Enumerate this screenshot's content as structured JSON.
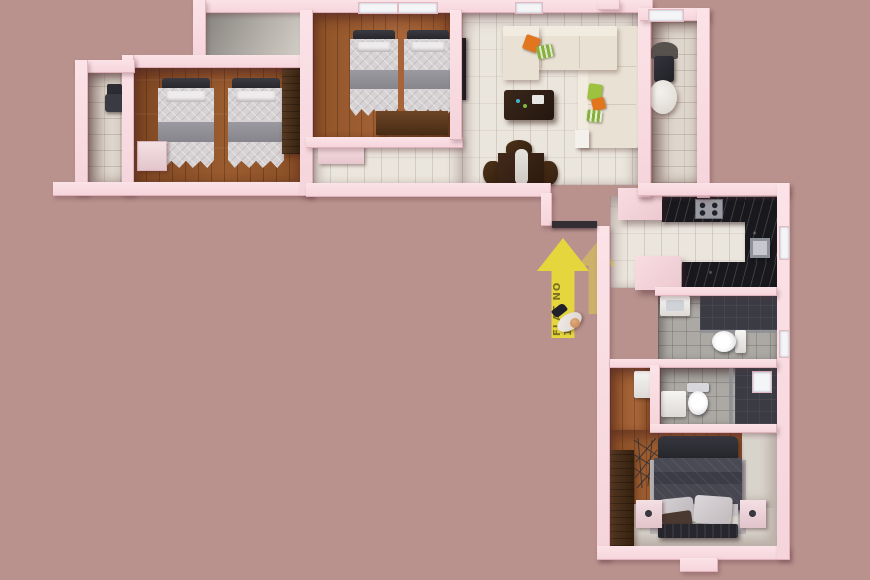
{
  "scene": {
    "description": "Top-down 3D architectural render of an L-shaped apartment, Flat No 1",
    "background_color": "#b9928e",
    "wall_color": "#f8dce1"
  },
  "signage": {
    "flat_arrow_label": "FLAT NO 1",
    "arrow_color": "#e6d63e",
    "arrow_text_color": "#7a7120",
    "arrow_direction": "up",
    "arrow_count": 2,
    "person_figure_at_entry": true
  },
  "palette": {
    "wood_floor": "#9a5c2f",
    "light_tile_floor": "#ebe6dd",
    "balcony_tile": "#ded6cc",
    "bath_tile": "#aca9a4",
    "marble_counter": "#18181d",
    "sofa": "#ece6da",
    "twin_bed_duvet": "#d7d2d4",
    "master_duvet": "#41414b",
    "dark_wood_furniture": "#3a2517",
    "accent_pillow_orange": "#e2761f",
    "accent_pillow_green": "#86b23c"
  },
  "rooms": [
    {
      "name": "bedroom-1",
      "floor": "wood",
      "furniture": [
        "twin bed",
        "twin bed",
        "wardrobe",
        "drawer unit"
      ]
    },
    {
      "name": "balcony-left",
      "floor": "tile",
      "furniture": [
        "chair"
      ]
    },
    {
      "name": "entrance-hall",
      "floor": "concrete"
    },
    {
      "name": "bedroom-2",
      "floor": "wood",
      "furniture": [
        "twin bed",
        "twin bed",
        "study desk",
        "window"
      ]
    },
    {
      "name": "hallway",
      "floor": "light tile",
      "furniture": [
        "sideboard"
      ]
    },
    {
      "name": "living-dining",
      "floor": "light tile",
      "furniture": [
        "corner sofa",
        "accent pillows",
        "coffee table",
        "wall tv",
        "dining table",
        "dining chairs",
        "wall shelf"
      ]
    },
    {
      "name": "balcony-right",
      "floor": "tile",
      "furniture": [
        "chair",
        "round table"
      ]
    },
    {
      "name": "kitchen",
      "floor": "tile",
      "furniture": [
        "u-shaped black marble counter",
        "gas hob",
        "sink",
        "tall cabinets",
        "window"
      ]
    },
    {
      "name": "bathroom-1",
      "floor": "tile",
      "furniture": [
        "wash basin",
        "toilet",
        "shower area",
        "window"
      ]
    },
    {
      "name": "bathroom-2",
      "floor": "tile",
      "furniture": [
        "bidet",
        "toilet",
        "shower area",
        "window"
      ]
    },
    {
      "name": "dressing-nook",
      "floor": "wood",
      "furniture": [
        "cabinet"
      ]
    },
    {
      "name": "master-bedroom",
      "floor": "wood and carpet",
      "furniture": [
        "double bed",
        "nightstand",
        "nightstand",
        "dresser",
        "bench",
        "geometric wall art"
      ]
    }
  ]
}
